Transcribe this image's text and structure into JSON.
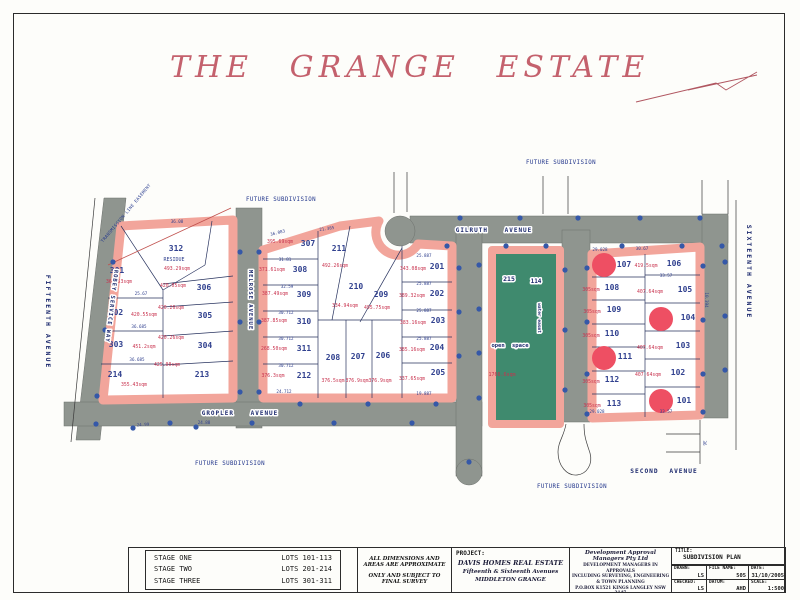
{
  "title": "THE GRANGE ESTATE",
  "map": {
    "streets": {
      "fifteenth": "FIFTEENTH AVENUE",
      "sixteenth": "SIXTEENTH AVENUE",
      "robey": "ROBEY SERVICE WAY",
      "melrose": "MELROSE AVENUE",
      "gilruth": "GILRUTH AVENUE",
      "gropler": "GROPLER AVENUE",
      "second": "SECOND AVENUE"
    },
    "future_subdivision": "FUTURE SUBDIVISION",
    "easement": "TRANSMISSION LINE EASEMENT",
    "open_space": {
      "label": "open space",
      "parcel": "215",
      "lot": "114",
      "water": "water easmt",
      "area": "1766.6sqm"
    },
    "lots": [
      {
        "number": "301",
        "area": "365.53sqm"
      },
      {
        "number": "302",
        "area": "420.55sqm"
      },
      {
        "number": "303",
        "area": "451.2sqm"
      },
      {
        "number": "214",
        "area": "355.43sqm"
      },
      {
        "number": "312",
        "note": "RESIDUE",
        "area": "493.29sqm"
      },
      {
        "number": "306",
        "area": "420.05sqm"
      },
      {
        "number": "305",
        "area": "420.26sqm"
      },
      {
        "number": "304",
        "area": "420.26sqm"
      },
      {
        "number": "213",
        "area": "425.00sqm"
      },
      {
        "number": "307",
        "area": "395.69sqm"
      },
      {
        "number": "308",
        "area": "371.61sqm"
      },
      {
        "number": "309",
        "area": "387.49sqm"
      },
      {
        "number": "310",
        "area": "387.85sqm"
      },
      {
        "number": "311",
        "area": "268.50sqm"
      },
      {
        "number": "212",
        "area": "376.3sqm"
      },
      {
        "number": "211",
        "area": "492.26sqm"
      },
      {
        "number": "210",
        "area": "334.94sqm"
      },
      {
        "number": "209",
        "area": "495.75sqm"
      },
      {
        "number": "208",
        "area": "376.5sqm"
      },
      {
        "number": "207",
        "area": "376.9sqm"
      },
      {
        "number": "206",
        "area": "376.9sqm"
      },
      {
        "number": "201",
        "area": "343.08sqm"
      },
      {
        "number": "202",
        "area": "389.32sqm"
      },
      {
        "number": "203",
        "area": "383.16sqm"
      },
      {
        "number": "204",
        "area": "385.16sqm"
      },
      {
        "number": "205",
        "area": "337.65sqm"
      },
      {
        "number": "107"
      },
      {
        "number": "108",
        "area": "305sqm"
      },
      {
        "number": "109",
        "area": "305sqm"
      },
      {
        "number": "110",
        "area": "305sqm"
      },
      {
        "number": "111"
      },
      {
        "number": "112",
        "area": "305sqm"
      },
      {
        "number": "113",
        "area": "305sqm"
      },
      {
        "number": "106",
        "area": "419.5sqm"
      },
      {
        "number": "105",
        "area": "407.64sqm"
      },
      {
        "number": "104"
      },
      {
        "number": "103",
        "area": "407.64sqm"
      },
      {
        "number": "102",
        "area": "407.64sqm"
      },
      {
        "number": "101"
      }
    ],
    "sold_lots": [
      "107",
      "111",
      "104",
      "101"
    ],
    "dimensions": [
      "36.08",
      "25.67",
      "36.685",
      "36.685",
      "24.99",
      "24.88",
      "36.083",
      "21.385",
      "31.81",
      "32.59",
      "30.712",
      "30.712",
      "30.712",
      "24.712",
      "25.887",
      "25.887",
      "25.887",
      "25.887",
      "19.887",
      "29.028",
      "29.028",
      "33.57",
      "33.57",
      "30.67",
      "10.394",
      "36"
    ]
  },
  "title_block": {
    "stages": [
      {
        "name": "STAGE ONE",
        "lots": "LOTS 101-113"
      },
      {
        "name": "STAGE TWO",
        "lots": "LOTS 201-214"
      },
      {
        "name": "STAGE THREE",
        "lots": "LOTS 301-311"
      }
    ],
    "disclaimer": [
      "ALL DIMENSIONS AND AREAS ARE APPROXIMATE",
      "ONLY AND SUBJECT TO FINAL SURVEY"
    ],
    "project": {
      "label": "PROJECT:",
      "name": "DAVIS HOMES REAL ESTATE",
      "address": "Fifteenth & Sixteenth Avenues",
      "suburb": "MIDDLETON GRANGE"
    },
    "consultant": {
      "name": "Development Approval Managers Pty Ltd",
      "line2": "DEVELOPMENT MANAGERS IN APPROVALS",
      "line3": "INCLUDING SURVEYING, ENGINEERING & TOWN PLANNING",
      "line4": "P.O.BOX K1521 KINGS LANGLEY NSW 2147",
      "line5": "4 Passionfruit Way  GLENWOOD  NSW 2768",
      "line6": "PH 8824 8100   FAX 8824 8500"
    },
    "title": {
      "label": "TITLE:",
      "value": "SUBDIVISION PLAN"
    },
    "fields": [
      {
        "label": "DRAWN:",
        "value": "LS"
      },
      {
        "label": "FILE NAME:",
        "value": "505"
      },
      {
        "label": "DATE:",
        "value": "31/10/2005"
      },
      {
        "label": "CHECKED:",
        "value": "LS"
      },
      {
        "label": "DATUM:",
        "value": "AHD"
      },
      {
        "label": "SCALE:",
        "value": "1:500"
      }
    ]
  }
}
